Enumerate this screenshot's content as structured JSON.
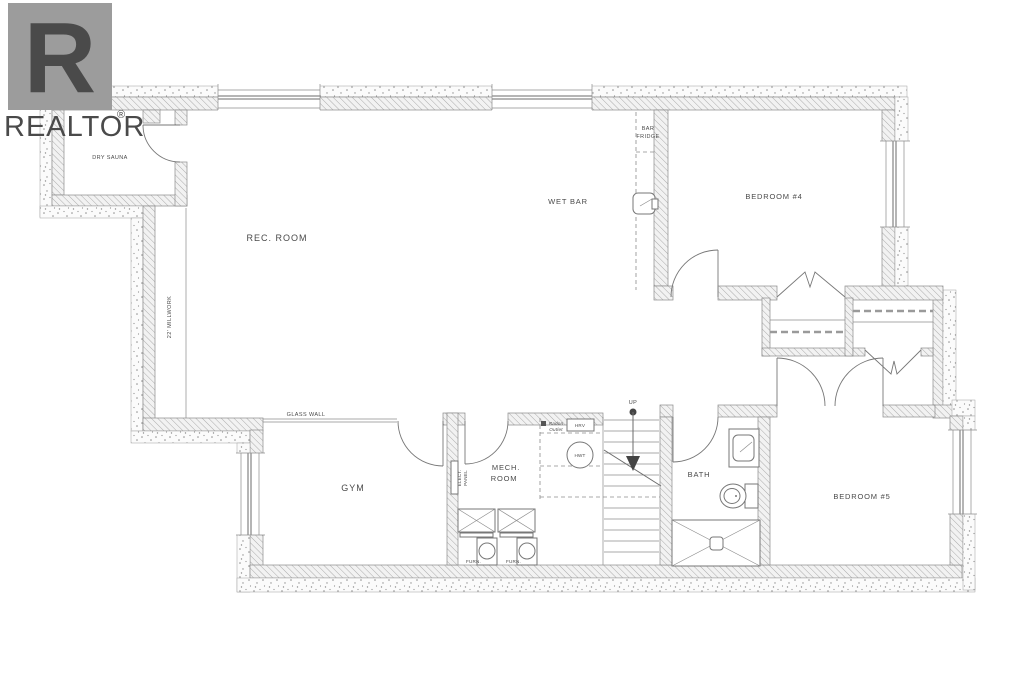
{
  "logo": {
    "brand": "REALTOR",
    "registered": "®",
    "letter": "R",
    "color": "#9c9c9c"
  },
  "floor_plan": {
    "rooms": {
      "dry_sauna": "DRY SAUNA",
      "rec_room": "REC. ROOM",
      "wet_bar": "WET BAR",
      "bedroom_4": "BEDROOM #4",
      "gym": "GYM",
      "mech_room_line_1": "MECH.",
      "mech_room_line_2": "ROOM",
      "bath": "BATH",
      "bedroom_5": "BEDROOM #5"
    },
    "annotations": {
      "bar_fridge_line_1": "BAR",
      "bar_fridge_line_2": "FRIDGE",
      "millwork": "22' MILLWORK",
      "glass_wall": "GLASS WALL",
      "elect_panel_line_1": "ELECT.",
      "elect_panel_line_2": "PANEL",
      "hot_water_tank": "HWT",
      "radon_line_1": "Radon",
      "radon_line_2": "Outlet",
      "hrv": "HRV",
      "stairs_up": "UP",
      "furnace_1": "FURN.",
      "furnace_2": "FURN."
    },
    "colors": {
      "wall_hatch": "#b3b3b3",
      "stipple_dots": "#8f8f8f",
      "line": "#666666",
      "text": "#4a4a4a"
    }
  }
}
